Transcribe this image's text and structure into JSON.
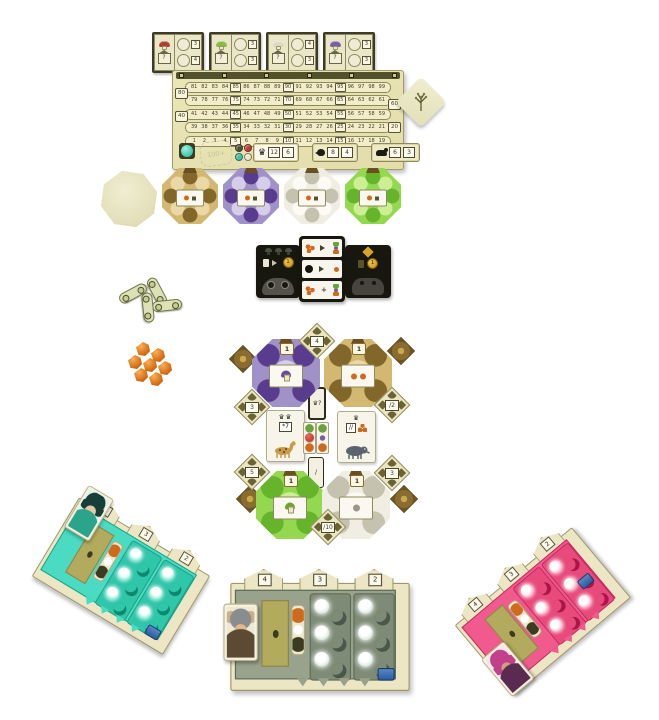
{
  "scene": {
    "background": "#ffffff",
    "description": "tabletop setup of a woodland mushroom board game"
  },
  "goal_row": {
    "tiles": [
      {
        "mushroom": "red-mushroom",
        "cap_color": "#b23b30",
        "question": "?",
        "badges": [
          "3",
          "4"
        ]
      },
      {
        "mushroom": "green-mushroom",
        "cap_color": "#8abb3f",
        "question": "?",
        "badges": [
          "3",
          "3"
        ]
      },
      {
        "mushroom": "white-mushroom",
        "cap_color": "#ddd8c0",
        "question": "?",
        "badges": [
          "4",
          "3"
        ]
      },
      {
        "mushroom": "purple-mushroom",
        "cap_color": "#7b5ca6",
        "question": "?",
        "badges": [
          "3",
          "3"
        ]
      }
    ]
  },
  "score_board": {
    "peg_count": 6,
    "track_rows": [
      {
        "cells": [
          "81",
          "82",
          "83",
          "84",
          "85",
          "86",
          "87",
          "88",
          "89",
          "90",
          "91",
          "92",
          "93",
          "94",
          "95",
          "96",
          "97",
          "98",
          "99"
        ]
      },
      {
        "cells": [
          "79",
          "78",
          "77",
          "76",
          "75",
          "74",
          "73",
          "72",
          "71",
          "70",
          "69",
          "68",
          "67",
          "66",
          "65",
          "64",
          "63",
          "62",
          "61"
        ]
      },
      {
        "cells": [
          "41",
          "42",
          "43",
          "44",
          "45",
          "46",
          "47",
          "48",
          "49",
          "50",
          "51",
          "52",
          "53",
          "54",
          "55",
          "56",
          "57",
          "58",
          "59"
        ]
      },
      {
        "cells": [
          "39",
          "38",
          "37",
          "36",
          "35",
          "34",
          "33",
          "32",
          "31",
          "30",
          "29",
          "28",
          "27",
          "26",
          "25",
          "24",
          "23",
          "22",
          "21"
        ]
      },
      {
        "cells": [
          "1",
          "2",
          "3",
          "4",
          "5",
          "6",
          "7",
          "8",
          "9",
          "10",
          "11",
          "12",
          "13",
          "14",
          "15",
          "16",
          "17",
          "18",
          "19"
        ]
      }
    ],
    "edge_boxes": [
      {
        "value": "80",
        "side": "left",
        "row_index": 1
      },
      {
        "value": "60",
        "side": "right",
        "row_index": 2
      },
      {
        "value": "40",
        "side": "left",
        "row_index": 3
      },
      {
        "value": "20",
        "side": "right",
        "row_index": 4
      }
    ],
    "hundred_stamp": "100+",
    "score_marker_color": "#3cc7ab",
    "player_tokens": [
      {
        "color": "#4c5133"
      },
      {
        "color": "#bf3a33"
      },
      {
        "color": "#38c2a6"
      },
      {
        "color": "#ece6cd"
      }
    ],
    "stat_panels": [
      {
        "icon": "crown-icon",
        "glyph": "♛",
        "values": [
          "12",
          "6"
        ]
      },
      {
        "icon": "bird-icon",
        "glyph": "",
        "values": [
          "8",
          "4"
        ]
      },
      {
        "icon": "sheep-icon",
        "glyph": "",
        "values": [
          "6",
          "3"
        ]
      }
    ]
  },
  "octagon_row": {
    "tiles": [
      {
        "name": "gold",
        "base": "#d3b871",
        "blob": "#83672a",
        "light": "#ead9a6"
      },
      {
        "name": "purple",
        "base": "#a091c8",
        "blob": "#5a3c8e",
        "light": "#d6cdea"
      },
      {
        "name": "white",
        "base": "#f0ede2",
        "blob": "#c6c2b0",
        "light": "#fbfaf5"
      },
      {
        "name": "green",
        "base": "#93d84e",
        "blob": "#66b42b",
        "light": "#ccef95"
      }
    ]
  },
  "den_board": {
    "mushroom_count": 3,
    "left_coin": "1",
    "right_coin": "1"
  },
  "cluster": {
    "octagons": [
      {
        "name": "purple",
        "badge": "1",
        "base": "#a091c8",
        "blob": "#5a3c8e",
        "light": "#d6cdea",
        "icon": "purple-mushroom",
        "icon_color": "#6a4a9a"
      },
      {
        "name": "gold",
        "badge": "1",
        "base": "#d3b871",
        "blob": "#83672a",
        "light": "#ead9a6",
        "icon": "orange-dots",
        "icon_color": ""
      },
      {
        "name": "green",
        "badge": "1",
        "base": "#93d84e",
        "blob": "#66b42b",
        "light": "#ccef95",
        "icon": "green-mushroom",
        "icon_color": "#6aa52c"
      },
      {
        "name": "white",
        "badge": "1",
        "base": "#f0ede2",
        "blob": "#c6c2b0",
        "light": "#fbfaf5",
        "icon": "gray-dot",
        "icon_color": ""
      }
    ],
    "diamonds": [
      {
        "value": "4"
      },
      {
        "value": "3"
      },
      {
        "value": "/2"
      },
      {
        "value": "5"
      },
      {
        "value": "3"
      },
      {
        "value": "/10"
      }
    ],
    "small_cards": [
      {
        "label": "♛?"
      },
      {
        "label": "/"
      }
    ],
    "mission_cards": [
      {
        "crowns": "♛♛",
        "tag": "*7",
        "animal": "okapi"
      },
      {
        "crowns": "♛",
        "tag": "//",
        "animal": "boar"
      }
    ]
  },
  "tokens": {
    "chain_count": 4,
    "crystal_count": 7
  },
  "player_boards": [
    {
      "id": "teal",
      "tower_numbers": [
        "4",
        "3",
        "2"
      ],
      "character": "teal-sprite"
    },
    {
      "id": "olive",
      "tower_numbers": [
        "4",
        "3",
        "2"
      ],
      "character": "antler-chief"
    },
    {
      "id": "pink",
      "tower_numbers": [
        "4",
        "3",
        "2"
      ],
      "character": "pink-sorceress"
    }
  ]
}
